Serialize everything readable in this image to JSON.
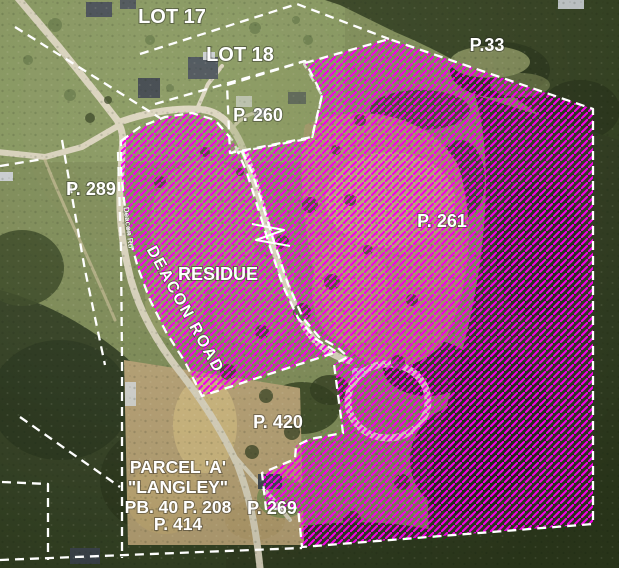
{
  "map": {
    "labels": [
      {
        "id": "lot-17",
        "text": "LOT 17"
      },
      {
        "id": "lot-18",
        "text": "LOT 18"
      },
      {
        "id": "p-33",
        "text": "P.33"
      },
      {
        "id": "p-260",
        "text": "P. 260"
      },
      {
        "id": "p-289",
        "text": "P. 289"
      },
      {
        "id": "p-261",
        "text": "P. 261"
      },
      {
        "id": "residue",
        "text": "RESIDUE"
      },
      {
        "id": "deacon-road",
        "text": "DEACON ROAD"
      },
      {
        "id": "deacon-rd-small",
        "text": "Deacon Rd"
      },
      {
        "id": "p-420",
        "text": "P. 420"
      },
      {
        "id": "parcel-a-line-1",
        "text": "PARCEL 'A'"
      },
      {
        "id": "parcel-a-line-2",
        "text": "\"LANGLEY\""
      },
      {
        "id": "parcel-a-line-3",
        "text": "PB. 40 P. 208"
      },
      {
        "id": "parcel-a-line-4",
        "text": "P. 414"
      },
      {
        "id": "p-269",
        "text": "P. 269"
      }
    ],
    "colors": {
      "hatch_magenta": "#f300e8",
      "boundary_white": "#ffffff",
      "label_white": "#ffffff"
    }
  }
}
